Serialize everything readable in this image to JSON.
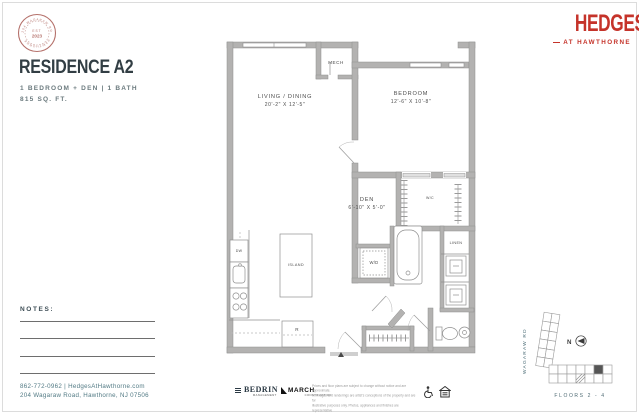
{
  "seal": {
    "est": "EST",
    "year": "2023",
    "arc_top": "204 WAGARAW RD",
    "arc_bottom": "HAWTHORNE"
  },
  "unit": {
    "title": "RESIDENCE A2",
    "specs": "1 BEDROOM + DEN  |  1 BATH",
    "area": "815 SQ. FT."
  },
  "brand": {
    "name": "HEDGES",
    "tagline": "AT HAWTHORNE"
  },
  "notes": {
    "label": "NOTES:"
  },
  "contact": {
    "line1": "862-772-0962 | HedgesAtHawthorne.com",
    "line2": "204 Wagaraw Road, Hawthorne, NJ 07506"
  },
  "plan": {
    "living": {
      "name": "LIVING / DINING",
      "dims": "20'-2\" X 12'-5\""
    },
    "bedroom": {
      "name": "BEDROOM",
      "dims": "12'-6\" X 10'-8\""
    },
    "den": {
      "name": "DEN",
      "dims": "6'-10\" X 5'-0\""
    },
    "mech": "MECH",
    "wd": "W/D",
    "wc": "W/C",
    "linen": "LINEN",
    "island": "ISLAND",
    "dw": "DW",
    "fridge": "R"
  },
  "keyplan": {
    "street": "WAGARAW RD",
    "north": "N",
    "floors": "FLOORS 2 - 4"
  },
  "footer": {
    "bedrin": {
      "name": "BEDRIN",
      "sub": "MANAGEMENT"
    },
    "march": {
      "name": "MARCH",
      "sub": "CONSTRUCTION"
    },
    "disclaimer": [
      "Prices and floor plans are subject to change without notice and are approximate.",
      "All images and renderings are artist's conceptions of the property and are for",
      "illustrative purposes only. Photos, appliances and finishes are representative",
      "and are intended to illustrate the community."
    ]
  },
  "colors": {
    "accent_red": "#c5332a",
    "seal_red": "#b5716b",
    "ink": "#333f45",
    "teal": "#567a84",
    "wall_gray": "#b3b2b1"
  }
}
